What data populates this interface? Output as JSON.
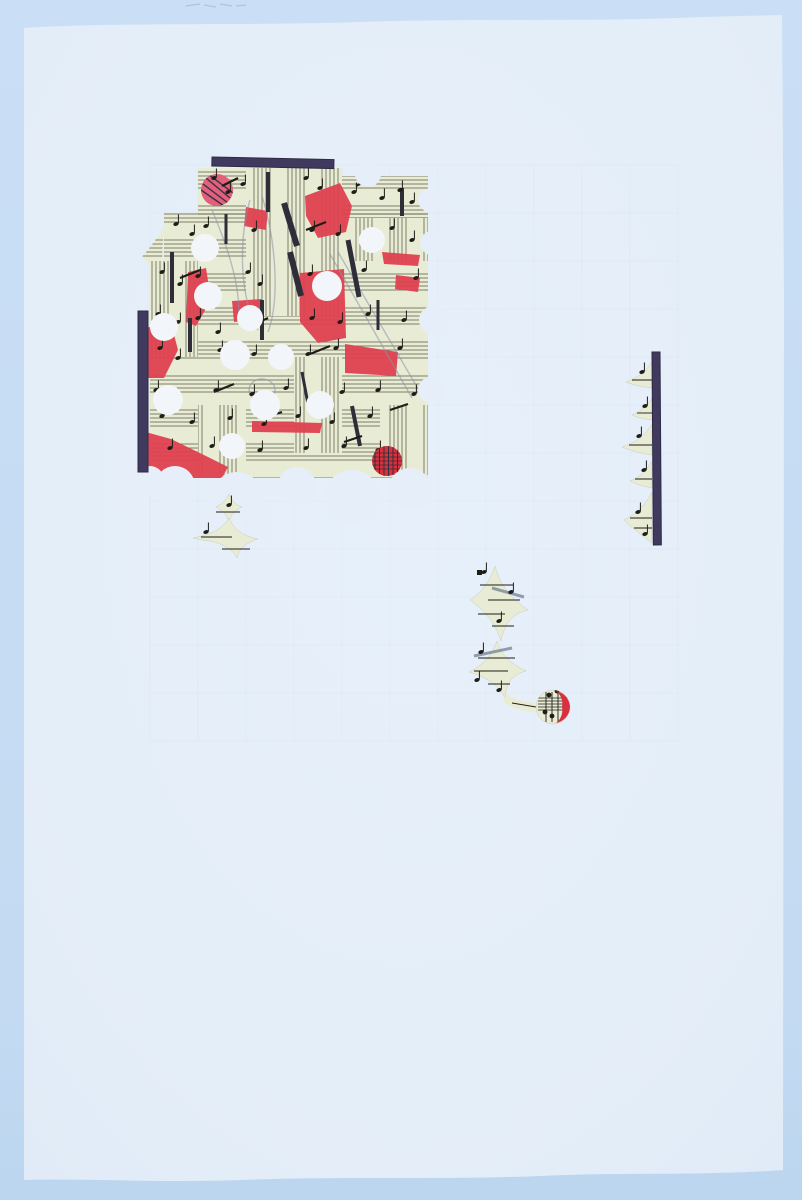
{
  "artwork": {
    "colors": {
      "bg_top": "#cadff5",
      "bg_bottom": "#bcd6ef",
      "paper": "#e4eef9",
      "paper_edge": "#dde9f6",
      "hole": "#f2f6fa",
      "bite": "#e5eef9",
      "sheet": "#e9ecd4",
      "staff": "#54523f",
      "ink": "#1e1d18",
      "bar": "#413a5f",
      "bar_dark": "#2e2a44",
      "red": "#df4150",
      "red_dark": "#d8303e",
      "pink": "#e2607a",
      "pencil": "#8a92ac",
      "grid": "#8fa3bf"
    },
    "paper_path": "M24,28 C120,22 240,26 360,22 C480,18 600,22 700,17 L782,15 L784,300 L783,1170 C700,1176 620,1172 540,1176 C440,1180 340,1176 240,1180 C160,1183 80,1178 24,1180 Z",
    "top_smudges": [
      [
        186,
        6,
        200,
        4
      ],
      [
        204,
        5,
        216,
        7
      ],
      [
        220,
        4,
        232,
        6
      ],
      [
        236,
        6,
        246,
        5
      ]
    ],
    "grid": {
      "x0": 150,
      "y0": 165,
      "step": 48,
      "cols": 11,
      "rows": 12
    },
    "collage": {
      "block_rects": [
        [
          198,
          168,
          144,
          48
        ],
        [
          342,
          176,
          86,
          42
        ],
        [
          164,
          213,
          264,
          48
        ],
        [
          150,
          261,
          278,
          217
        ]
      ],
      "left_wedge": "M166,223 C158,238 148,250 142,257 C150,266 160,278 166,292 C161,272 161,243 166,223 Z",
      "vertical_patches": [
        [
          246,
          168,
          96,
          148
        ],
        [
          150,
          261,
          48,
          96
        ],
        [
          342,
          218,
          86,
          43
        ],
        [
          294,
          357,
          48,
          96
        ],
        [
          198,
          405,
          48,
          70
        ],
        [
          380,
          405,
          48,
          70
        ]
      ],
      "red_polys": [
        "305,196 340,183 352,206 346,232 318,238 306,216",
        "300,273 344,269 346,338 318,343 300,322",
        "345,344 398,352 396,376 345,373",
        "140,329 171,323 178,350 164,378 141,378",
        "142,431 171,439 206,456 228,467 222,478 159,478 141,463",
        "246,207 268,211 266,230 244,226",
        "232,301 262,299 264,319 234,322",
        "382,252 420,255 418,266 384,264",
        "396,275 420,278 418,292 395,289",
        "188,272 206,268 211,300 196,326 186,322",
        "252,421 322,423 320,433 252,432"
      ],
      "pink_circle": [
        217,
        190,
        16
      ],
      "pink_strings": [
        [
          206,
          178,
          230,
          198
        ],
        [
          203,
          184,
          228,
          203
        ],
        [
          201,
          190,
          224,
          206
        ],
        [
          208,
          174,
          233,
          193
        ]
      ],
      "thick_lines": [
        [
          268,
          172,
          268,
          212,
          4
        ],
        [
          284,
          203,
          297,
          246,
          6
        ],
        [
          290,
          252,
          301,
          296,
          6
        ],
        [
          262,
          300,
          262,
          340,
          4
        ],
        [
          402,
          188,
          402,
          216,
          4
        ],
        [
          348,
          240,
          359,
          297,
          5
        ],
        [
          172,
          252,
          172,
          303,
          4
        ],
        [
          190,
          318,
          190,
          352,
          4
        ],
        [
          352,
          406,
          360,
          446,
          4
        ],
        [
          302,
          372,
          308,
          404,
          3
        ],
        [
          226,
          214,
          226,
          244,
          3
        ],
        [
          378,
          300,
          378,
          330,
          3
        ]
      ],
      "beams": [
        [
          222,
          186,
          238,
          178
        ],
        [
          356,
          186,
          372,
          178
        ],
        [
          306,
          230,
          326,
          222
        ],
        [
          180,
          278,
          200,
          270
        ],
        [
          250,
          326,
          268,
          318
        ],
        [
          310,
          354,
          330,
          346
        ],
        [
          214,
          392,
          234,
          384
        ],
        [
          262,
          418,
          282,
          412
        ],
        [
          344,
          442,
          362,
          436
        ],
        [
          390,
          410,
          408,
          404
        ]
      ],
      "pencil_curves": [
        "M250,200 C238,240 240,300 258,330",
        "M262,196 C276,240 280,300 268,332",
        "M330,254 L412,398",
        "M338,252 L420,392",
        "M249,390 a13,11 0 1 0 26,0 a13,11 0 1 0 -26,0",
        "M212,210 C230,252 242,292 238,322"
      ],
      "notes": [
        [
          214,
          178
        ],
        [
          228,
          192
        ],
        [
          243,
          184
        ],
        [
          306,
          178
        ],
        [
          320,
          188
        ],
        [
          354,
          192
        ],
        [
          368,
          184
        ],
        [
          382,
          198
        ],
        [
          400,
          190
        ],
        [
          412,
          202
        ],
        [
          176,
          224
        ],
        [
          192,
          234
        ],
        [
          206,
          226
        ],
        [
          254,
          230
        ],
        [
          312,
          230
        ],
        [
          338,
          234
        ],
        [
          392,
          228
        ],
        [
          412,
          240
        ],
        [
          162,
          272
        ],
        [
          180,
          284
        ],
        [
          198,
          276
        ],
        [
          248,
          272
        ],
        [
          260,
          284
        ],
        [
          310,
          274
        ],
        [
          364,
          270
        ],
        [
          416,
          278
        ],
        [
          158,
          314
        ],
        [
          178,
          322
        ],
        [
          198,
          318
        ],
        [
          218,
          332
        ],
        [
          246,
          326
        ],
        [
          312,
          318
        ],
        [
          340,
          322
        ],
        [
          368,
          314
        ],
        [
          404,
          320
        ],
        [
          160,
          348
        ],
        [
          178,
          358
        ],
        [
          220,
          350
        ],
        [
          254,
          354
        ],
        [
          308,
          354
        ],
        [
          336,
          348
        ],
        [
          400,
          348
        ],
        [
          156,
          390
        ],
        [
          174,
          398
        ],
        [
          216,
          390
        ],
        [
          252,
          394
        ],
        [
          286,
          388
        ],
        [
          342,
          392
        ],
        [
          378,
          390
        ],
        [
          414,
          394
        ],
        [
          162,
          416
        ],
        [
          192,
          422
        ],
        [
          230,
          418
        ],
        [
          264,
          424
        ],
        [
          298,
          416
        ],
        [
          332,
          422
        ],
        [
          370,
          416
        ],
        [
          170,
          448
        ],
        [
          212,
          446
        ],
        [
          260,
          450
        ],
        [
          306,
          448
        ],
        [
          344,
          446
        ],
        [
          378,
          450
        ]
      ],
      "interior_holes": [
        [
          205,
          248,
          14
        ],
        [
          372,
          240,
          13
        ],
        [
          208,
          296,
          14
        ],
        [
          327,
          286,
          15
        ],
        [
          250,
          318,
          13
        ],
        [
          164,
          327,
          14
        ],
        [
          235,
          355,
          15
        ],
        [
          281,
          357,
          13
        ],
        [
          168,
          400,
          15
        ],
        [
          265,
          405,
          15
        ],
        [
          320,
          405,
          14
        ],
        [
          232,
          446,
          13
        ]
      ],
      "edge_bites": [
        [
          368,
          174,
          13
        ],
        [
          430,
          200,
          12
        ],
        [
          432,
          243,
          12
        ],
        [
          433,
          320,
          14
        ],
        [
          431,
          390,
          13
        ],
        [
          175,
          486,
          20
        ],
        [
          237,
          497,
          25
        ],
        [
          297,
          486,
          19
        ],
        [
          352,
          497,
          27
        ],
        [
          410,
          489,
          21
        ],
        [
          150,
          480,
          14
        ]
      ],
      "red_disc": [
        387,
        461,
        15
      ],
      "top_bar": [
        212,
        157,
        122,
        9,
        1.2
      ],
      "left_bar": [
        138,
        311,
        10,
        161
      ]
    },
    "cross_fragment": {
      "paths": [
        "M229,494 C232,501 236,505 242,507 C236,510 231,514 229,521 C226,514 222,510 216,507 C222,504 226,500 229,494 Z",
        "M229,518 Q236,535 258,539 Q240,544 237,558 Q230,545 210,541 Q200,540 193,538 Q221,533 229,518 Z"
      ],
      "lines": [
        [
          216,
          512,
          240,
          512
        ],
        [
          201,
          537,
          232,
          537
        ],
        [
          222,
          549,
          250,
          549
        ]
      ],
      "notes": [
        [
          229,
          505
        ],
        [
          206,
          532
        ]
      ]
    },
    "right_strip": {
      "bar": [
        652,
        352,
        8,
        193,
        -0.4
      ],
      "cusps": [
        "M652,362 C646,372 637,378 626,382 C635,386 645,387 652,388 Z",
        "M652,398 C647,406 640,412 632,415 C638,418 646,419 652,420 Z",
        "M652,424 C646,434 638,442 622,447 C634,452 646,454 652,455 Z",
        "M652,461 C647,470 640,477 630,481 C638,485 646,487 652,488 Z",
        "M652,492 C646,504 637,514 624,520 C634,530 646,538 652,543 Z"
      ],
      "lines": [
        [
          632,
          380,
          652,
          380
        ],
        [
          637,
          413,
          652,
          413
        ],
        [
          629,
          445,
          652,
          445
        ],
        [
          635,
          479,
          652,
          479
        ],
        [
          630,
          518,
          652,
          518
        ],
        [
          634,
          528,
          652,
          528
        ]
      ],
      "notes": [
        [
          642,
          372
        ],
        [
          645,
          406
        ],
        [
          639,
          436
        ],
        [
          644,
          470
        ],
        [
          638,
          512
        ],
        [
          645,
          534
        ]
      ]
    },
    "chain": {
      "stars": [
        "M495,566 Q501,592 528,610 Q506,614 501,641 Q494,617 470,600 Q488,588 495,566 Z",
        "M497,641 Q502,660 526,671 Q506,676 505,698 Q497,680 469,672 Q490,662 497,641 Z"
      ],
      "tail": "M506,694 Q520,702 537,703 L537,712 Q518,712 503,702 Z",
      "lines": [
        [
          480,
          585,
          513,
          585
        ],
        [
          488,
          600,
          520,
          600
        ],
        [
          478,
          614,
          505,
          614
        ],
        [
          492,
          626,
          514,
          626
        ],
        [
          478,
          658,
          515,
          658
        ],
        [
          474,
          671,
          508,
          671
        ],
        [
          488,
          684,
          510,
          684
        ],
        [
          512,
          703,
          536,
          707
        ]
      ],
      "beams": [
        [
          492,
          588,
          524,
          597
        ],
        [
          474,
          656,
          512,
          648
        ]
      ],
      "notes": [
        [
          484,
          572
        ],
        [
          511,
          592
        ],
        [
          499,
          621
        ],
        [
          481,
          652
        ],
        [
          477,
          680
        ],
        [
          499,
          690
        ]
      ],
      "dot": [
        477,
        570,
        5,
        5
      ]
    },
    "music_disc": {
      "circle": [
        553,
        707,
        17
      ],
      "vlines": [
        546,
        552,
        558
      ],
      "vrange": [
        692,
        722
      ],
      "hlines": [
        698,
        701,
        704,
        707,
        710
      ],
      "hrange": [
        538,
        567
      ],
      "blobs": [
        [
          549,
          695
        ],
        [
          545,
          712
        ],
        [
          557,
          691
        ],
        [
          552,
          716
        ]
      ],
      "crescent": "M556,691 A17,17 0 0 1 570,707 A17,17 0 0 1 556,723 A16,16 0 0 0 562,707 A16,16 0 0 0 556,691 Z"
    }
  }
}
